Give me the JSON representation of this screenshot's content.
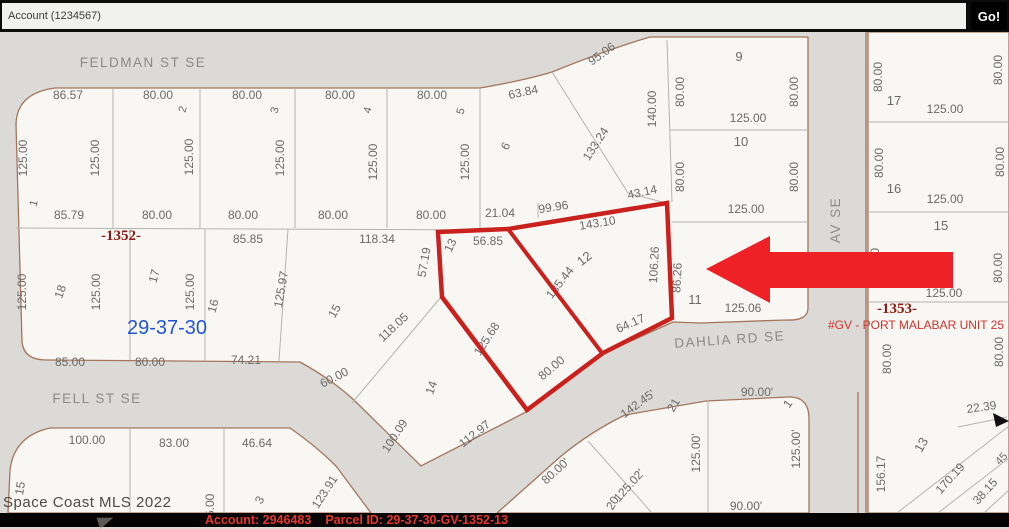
{
  "toolbar": {
    "account_field_value": "Account (1234567)",
    "go_button_label": "Go!"
  },
  "watermark": "Space Coast MLS 2022",
  "statusbar": {
    "account_text": "Account: 2946483",
    "parcel_text": "Parcel ID: 29-37-30-GV-1352-13"
  },
  "map": {
    "colors": {
      "street_fill": "#dcdad7",
      "parcel_fill": "#f8f7f4",
      "boundary": "#a3755d",
      "lot_line": "#b5b3b0",
      "dim_text": "#6b6a68",
      "street_text": "#8b8a88",
      "section_blue": "#2553d6",
      "block_red": "#8e1b12",
      "unit_red": "#d0342c",
      "highlight": "#c9221e",
      "arrow": "#ee2126",
      "cursor": "#111111"
    },
    "blocks": [
      "M16,124 Q17,93 55,88 L480,88 Q526,80 552,72 Q606,50 650,37 L808,37 L808,308 Q808,321 786,320 L700,323 L673,322 L602,354 L528,411 L421,466 L358,404 Q336,382 300,362 L46,360 Q24,360 22,342 Z",
      "M868,32 L1009,32 L1009,513 L868,513 Z",
      "M8,513 L10,470 Q14,436 50,428 L290,428 Q316,446 336,466 L371,513 Z",
      "M497,513 L560,457 Q590,432 625,415 L706,401 L788,397 Q809,396 809,419 L809,513 Z"
    ],
    "lot_lines": [
      "113,88 113,228",
      "200,88 200,228",
      "295,88 295,228",
      "387,88 387,228",
      "480,88 480,229",
      "16,228 506,230",
      "130,229 130,360",
      "205,229 205,361",
      "288,229 279,361",
      "441,297 352,403",
      "552,72 628,193",
      "628,193 666,203",
      "667,40 672,202",
      "670,130 808,130",
      "672,222 808,222",
      "868,122 1009,122",
      "868,212 1009,212",
      "868,302 1009,302",
      "958,427 1007,417",
      "897,513 1009,426",
      "938,513 1009,458",
      "984,513 1009,490",
      "130,428 130,513",
      "224,428 224,513",
      "708,400 708,513",
      "588,441 652,513",
      "538,203 538,218"
    ],
    "street_edge_lines": [
      "866,32 866,513",
      "858,392 858,513"
    ],
    "labels": [
      [
        "FELDMAN ST SE",
        143,
        67,
        0,
        13.5,
        "street"
      ],
      [
        "FELL ST SE",
        97,
        403,
        0,
        13.5,
        "street"
      ],
      [
        "DAHLIA RD SE",
        730,
        344,
        -4,
        13.5,
        "street"
      ],
      [
        "AV SE",
        840,
        220,
        -90,
        13.5,
        "street"
      ],
      [
        "86.57",
        68,
        99,
        0,
        12,
        "dim"
      ],
      [
        "80.00",
        158,
        99,
        0,
        12,
        "dim"
      ],
      [
        "80.00",
        247,
        99,
        0,
        12,
        "dim"
      ],
      [
        "80.00",
        340,
        99,
        0,
        12,
        "dim"
      ],
      [
        "80.00",
        432,
        99,
        0,
        12,
        "dim"
      ],
      [
        "63.84",
        524,
        96,
        -12,
        12,
        "dim"
      ],
      [
        "95.06",
        604,
        57,
        -36,
        12,
        "dim"
      ],
      [
        "133.24",
        599,
        146,
        -57,
        12,
        "dim"
      ],
      [
        "140.00",
        656,
        109,
        -90,
        12,
        "dim"
      ],
      [
        "43.14",
        643,
        196,
        -12,
        12,
        "dim"
      ],
      [
        "125.00",
        27,
        158,
        -90,
        12,
        "dim"
      ],
      [
        "125.00",
        99,
        158,
        -90,
        12,
        "dim"
      ],
      [
        "125.00",
        193,
        157,
        -90,
        12,
        "dim"
      ],
      [
        "125.00",
        284,
        158,
        -90,
        12,
        "dim"
      ],
      [
        "125.00",
        377,
        162,
        -90,
        12,
        "dim"
      ],
      [
        "125.00",
        469,
        162,
        -90,
        12,
        "dim"
      ],
      [
        "85.79",
        69,
        219,
        0,
        12,
        "dim"
      ],
      [
        "80.00",
        157,
        219,
        0,
        12,
        "dim"
      ],
      [
        "80.00",
        243,
        219,
        0,
        12,
        "dim"
      ],
      [
        "80.00",
        333,
        219,
        0,
        12,
        "dim"
      ],
      [
        "80.00",
        431,
        219,
        0,
        12,
        "dim"
      ],
      [
        "21.04",
        500,
        217,
        0,
        12,
        "dim"
      ],
      [
        "99.96",
        554,
        211,
        -9,
        12,
        "dim"
      ],
      [
        "143.10",
        598,
        227,
        -9,
        12,
        "dim"
      ],
      [
        "1",
        37,
        204,
        -75,
        11,
        "dim"
      ],
      [
        "2",
        186,
        110,
        -75,
        11,
        "dim"
      ],
      [
        "3",
        278,
        111,
        -75,
        11,
        "dim"
      ],
      [
        "4",
        371,
        111,
        -75,
        11,
        "dim"
      ],
      [
        "5",
        464,
        112,
        -75,
        11,
        "dim"
      ],
      [
        "6",
        509,
        148,
        -60,
        12,
        "dim"
      ],
      [
        "9",
        739,
        61,
        0,
        13,
        "dim"
      ],
      [
        "80.00",
        684,
        92,
        -90,
        12,
        "dim"
      ],
      [
        "80.00",
        798,
        92,
        -90,
        12,
        "dim"
      ],
      [
        "125.00",
        748,
        122,
        0,
        12,
        "dim"
      ],
      [
        "10",
        741,
        146,
        0,
        13,
        "dim"
      ],
      [
        "80.00",
        684,
        177,
        -90,
        12,
        "dim"
      ],
      [
        "80.00",
        798,
        177,
        -90,
        12,
        "dim"
      ],
      [
        "125.00",
        746,
        213,
        0,
        12,
        "dim"
      ],
      [
        "11",
        695,
        304,
        0,
        13,
        "dim"
      ],
      [
        "125.06",
        743,
        312,
        0,
        12,
        "dim"
      ],
      [
        "80.00",
        882,
        77,
        -90,
        12,
        "dim"
      ],
      [
        "17",
        894,
        105,
        0,
        13,
        "dim"
      ],
      [
        "125.00",
        945,
        113,
        0,
        12,
        "dim"
      ],
      [
        "80.00",
        1002,
        70,
        -90,
        12,
        "dim"
      ],
      [
        "80.00",
        883,
        163,
        -90,
        12,
        "dim"
      ],
      [
        "16",
        894,
        193,
        0,
        13,
        "dim"
      ],
      [
        "125.00",
        945,
        203,
        0,
        12,
        "dim"
      ],
      [
        "80.00",
        1004,
        162,
        -90,
        12,
        "dim"
      ],
      [
        "15",
        941,
        230,
        0,
        13,
        "dim"
      ],
      [
        "80.00",
        1002,
        268,
        -90,
        12,
        "dim"
      ],
      [
        "80.00",
        879,
        263,
        -90,
        12,
        "dim"
      ],
      [
        "125.00",
        944,
        297,
        0,
        12,
        "dim"
      ],
      [
        "-1353-",
        897,
        313,
        0,
        15,
        "darkred"
      ],
      [
        "#GV - PORT MALABAR UNIT 25",
        916,
        329,
        0,
        12,
        "red"
      ],
      [
        "80.00",
        891,
        359,
        -90,
        12,
        "dim"
      ],
      [
        "80.00",
        1003,
        352,
        -90,
        12,
        "dim"
      ],
      [
        "22.39",
        982,
        411,
        -8,
        12,
        "dim"
      ],
      [
        "13",
        925,
        447,
        -60,
        13,
        "dim"
      ],
      [
        "156.17",
        885,
        474,
        -90,
        12,
        "dim"
      ],
      [
        "170.19",
        953,
        481,
        -48,
        12,
        "dim"
      ],
      [
        "38.15",
        988,
        494,
        -48,
        12,
        "dim"
      ],
      [
        "45",
        1004,
        461,
        -48,
        11,
        "dim"
      ],
      [
        "-1352-",
        121,
        240,
        0,
        15,
        "darkred"
      ],
      [
        "85.85",
        248,
        243,
        0,
        12,
        "dim"
      ],
      [
        "118.34",
        377,
        243,
        0,
        12,
        "dim"
      ],
      [
        "125.00",
        26,
        292,
        -90,
        12,
        "dim"
      ],
      [
        "18",
        64,
        293,
        -70,
        12,
        "dim"
      ],
      [
        "125.00",
        100,
        292,
        -90,
        12,
        "dim"
      ],
      [
        "17",
        158,
        277,
        -75,
        12,
        "dim"
      ],
      [
        "125.00",
        194,
        292,
        -90,
        12,
        "dim"
      ],
      [
        "16",
        217,
        307,
        -75,
        12,
        "dim"
      ],
      [
        "125.97",
        285,
        290,
        -80,
        12,
        "dim"
      ],
      [
        "15",
        338,
        313,
        -60,
        12,
        "dim"
      ],
      [
        "29-37-30",
        167,
        334,
        0,
        20,
        "blue"
      ],
      [
        "85.00",
        70,
        366,
        0,
        12,
        "dim"
      ],
      [
        "80.00",
        150,
        366,
        0,
        12,
        "dim"
      ],
      [
        "74.21",
        246,
        364,
        0,
        12,
        "dim"
      ],
      [
        "118.05",
        396,
        330,
        -43,
        12,
        "dim"
      ],
      [
        "14",
        435,
        389,
        -70,
        12,
        "dim"
      ],
      [
        "60.00",
        336,
        381,
        -27,
        12,
        "dim"
      ],
      [
        "100.09",
        398,
        438,
        -57,
        12,
        "dim"
      ],
      [
        "112.97",
        477,
        437,
        -38,
        12,
        "dim"
      ],
      [
        "123.91",
        328,
        494,
        -57,
        12,
        "dim"
      ],
      [
        "57.19",
        428,
        263,
        -80,
        12,
        "dim"
      ],
      [
        "13",
        454,
        247,
        -65,
        12,
        "dim"
      ],
      [
        "56.85",
        488,
        245,
        0,
        12,
        "dim"
      ],
      [
        "12",
        587,
        262,
        -38,
        13,
        "dim"
      ],
      [
        "135.44",
        563,
        285,
        -52,
        12,
        "dim"
      ],
      [
        "106.26",
        658,
        265,
        -87,
        12,
        "dim"
      ],
      [
        "86.26",
        681,
        278,
        -87,
        12,
        "dim"
      ],
      [
        "64.17",
        632,
        327,
        -24,
        12,
        "dim"
      ],
      [
        "125.68",
        490,
        341,
        -57,
        12,
        "dim"
      ],
      [
        "80.00",
        554,
        371,
        -40,
        12,
        "dim"
      ],
      [
        "100.00",
        87,
        444,
        0,
        12,
        "dim"
      ],
      [
        "83.00",
        174,
        447,
        0,
        12,
        "dim"
      ],
      [
        "46.64",
        257,
        447,
        0,
        12,
        "dim"
      ],
      [
        "15",
        24,
        489,
        -80,
        12,
        "dim"
      ],
      [
        "125.00",
        214,
        512,
        -90,
        12,
        "dim"
      ],
      [
        "3",
        263,
        502,
        -60,
        12,
        "dim"
      ],
      [
        "142.45'",
        640,
        407,
        -36,
        12,
        "dim"
      ],
      [
        "21",
        677,
        407,
        -60,
        12,
        "dim"
      ],
      [
        "90.00'",
        757,
        396,
        0,
        12,
        "dim"
      ],
      [
        "1",
        791,
        406,
        -55,
        12,
        "dim"
      ],
      [
        "125.00'",
        700,
        453,
        -90,
        12,
        "dim"
      ],
      [
        "125.00'",
        800,
        449,
        -90,
        12,
        "dim"
      ],
      [
        "80.00'",
        558,
        474,
        -42,
        12,
        "dim"
      ],
      [
        "125.02'",
        632,
        488,
        -48,
        12,
        "dim"
      ],
      [
        "20",
        616,
        505,
        -60,
        12,
        "dim"
      ],
      [
        "90.00'",
        746,
        510,
        0,
        12,
        "dim"
      ]
    ],
    "target_parcel": {
      "outline": "438,232 508,229 667,203 672,318 603,353 527,410 442,297",
      "divider": "508,229 602,353"
    },
    "arrow_points": "706,269 770,236 770,252 953,252 953,288 770,288 770,303",
    "cursor_points": "993,413 1009,421 996,427"
  }
}
